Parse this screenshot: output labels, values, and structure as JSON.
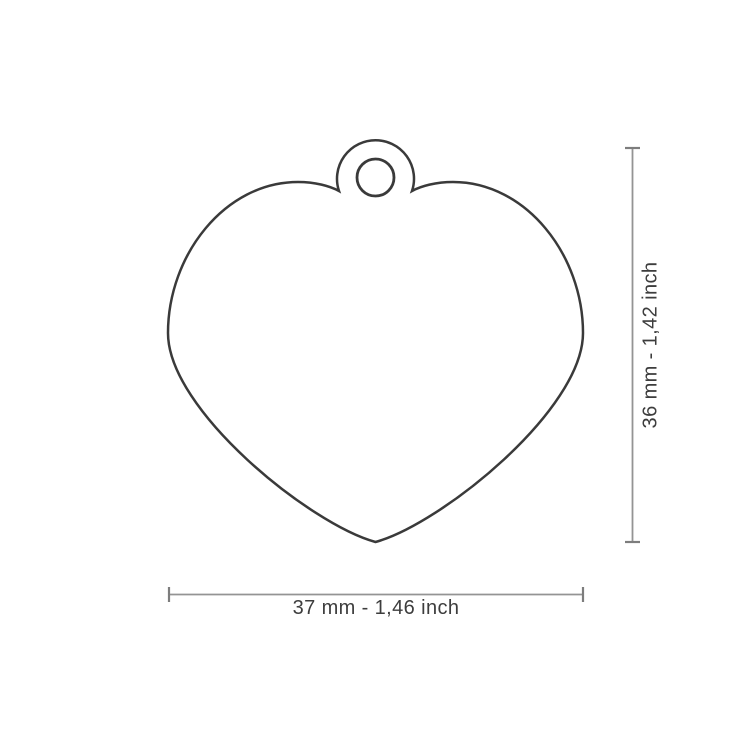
{
  "diagram": {
    "subject": "heart-shaped-tag-outline-with-hanging-hole",
    "width_label": "37 mm - 1,46 inch",
    "height_label": "36 mm - 1,42 inch",
    "colors": {
      "background": "#ffffff",
      "outline": "#3a3a3a",
      "dimension_line": "#949494",
      "dimension_tick": "#7d7d7d",
      "label_text": "#3d3d3d"
    }
  }
}
